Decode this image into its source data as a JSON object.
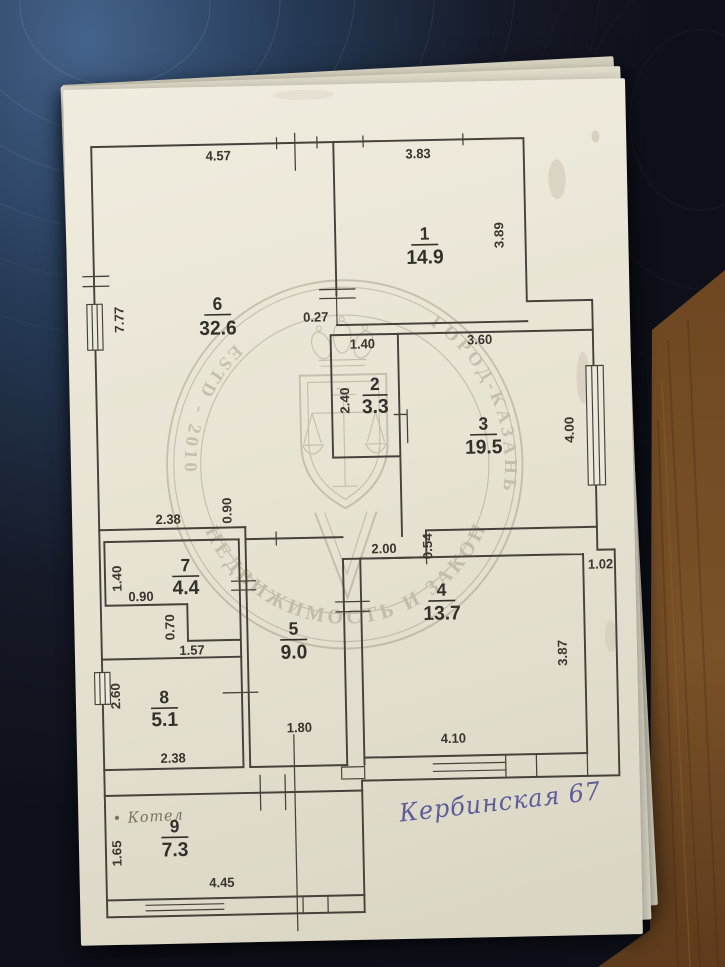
{
  "photo": {
    "description": "Photo of apartment floor plan sheet on dark table",
    "colors": {
      "paper": "#e8e3d3",
      "plan_line": "#46423a",
      "surface_blue": "#44638c",
      "surface_dark": "#0e1019",
      "wood": "#7a5128",
      "handwriting_ink": "#5c5d99",
      "watermark": "#8e8470"
    }
  },
  "plan": {
    "rooms": [
      {
        "num": "1",
        "area": "14.9"
      },
      {
        "num": "2",
        "area": "3.3"
      },
      {
        "num": "3",
        "area": "19.5"
      },
      {
        "num": "4",
        "area": "13.7"
      },
      {
        "num": "5",
        "area": "9.0"
      },
      {
        "num": "6",
        "area": "32.6"
      },
      {
        "num": "7",
        "area": "4.4"
      },
      {
        "num": "8",
        "area": "5.1"
      },
      {
        "num": "9",
        "area": "7.3"
      }
    ],
    "dims": {
      "top6": "4.57",
      "top1": "3.83",
      "left6": "7.77",
      "right1": "3.89",
      "w027": "0.27",
      "top2": "1.40",
      "left2": "2.40",
      "top3": "3.60",
      "right3": "4.00",
      "bot6": "2.38",
      "step090": "0.90",
      "left7": "1.40",
      "bot7": "0.90",
      "notch070": "0.70",
      "top8": "1.57",
      "left8": "2.60",
      "bot8": "2.38",
      "hall200": "2.00",
      "step054": "0.54",
      "cor102": "1.02",
      "bot5": "1.80",
      "bot4": "4.10",
      "right4": "3.87",
      "left9": "1.65",
      "bot9": "4.45"
    },
    "notes": {
      "address": "Кербинская 67",
      "boiler": "• Котел"
    },
    "watermark": {
      "bottom_arc": "НЕДВИЖИМОСТЬ И ЗАКОН",
      "right_arc": "ГОРОД-КАЗАНЬ",
      "left_arc": "ESTD - 2010"
    }
  }
}
